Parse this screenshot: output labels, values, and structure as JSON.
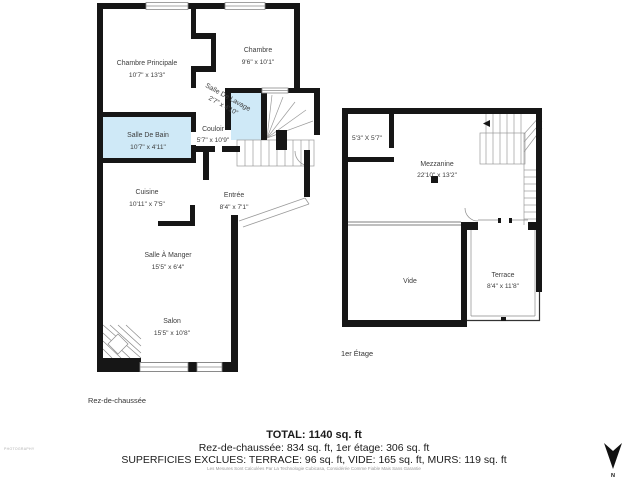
{
  "ground_floor": {
    "label": "Rez-de-chaussée",
    "rooms": [
      {
        "name": "Chambre Principale",
        "dims": "10'7\" x 13'3\""
      },
      {
        "name": "Chambre",
        "dims": "9'6\" x 10'1\""
      },
      {
        "name": "Salle De Lavage",
        "dims": "2'7\" x 4'10\""
      },
      {
        "name": "Salle De Bain",
        "dims": "10'7\" x 4'11\""
      },
      {
        "name": "Couloir",
        "dims": "5'7\" x 10'9\""
      },
      {
        "name": "Cuisine",
        "dims": "10'11\" x 7'5\""
      },
      {
        "name": "Entrée",
        "dims": "8'4\" x 7'1\""
      },
      {
        "name": "Salle À Manger",
        "dims": "15'5\" x 6'4\""
      },
      {
        "name": "Salon",
        "dims": "15'5\" x 10'8\""
      }
    ]
  },
  "first_floor": {
    "label": "1er Étage",
    "rooms": [
      {
        "name": "",
        "dims": "5'3\" X 5'7\""
      },
      {
        "name": "Mezzanine",
        "dims": "22'10\" x 13'2\""
      },
      {
        "name": "Vide",
        "dims": ""
      },
      {
        "name": "Terrace",
        "dims": "8'4\" x 11'8\""
      }
    ]
  },
  "summary": {
    "total": "TOTAL: 1140 sq. ft",
    "floors": "Rez-de-chaussée: 834 sq. ft, 1er étage: 306 sq. ft",
    "excluded": "SUPERFICIES EXCLUES: TERRACE: 96 sq. ft, VIDE: 165 sq. ft, MURS: 119 sq. ft",
    "disclaimer": "Les Mesures Sont Calculées Par La Technologie Cubicasa, Considérée Comme Fiable Mais Sans Garantie"
  },
  "compass": {
    "label": "N"
  },
  "watermark": "PHOTOGRAPHY",
  "colors": {
    "wall": "#161616",
    "highlight_room": "#cfe9f7",
    "stair_line": "#9a9a9a",
    "window_stroke": "#8a8a8a"
  }
}
